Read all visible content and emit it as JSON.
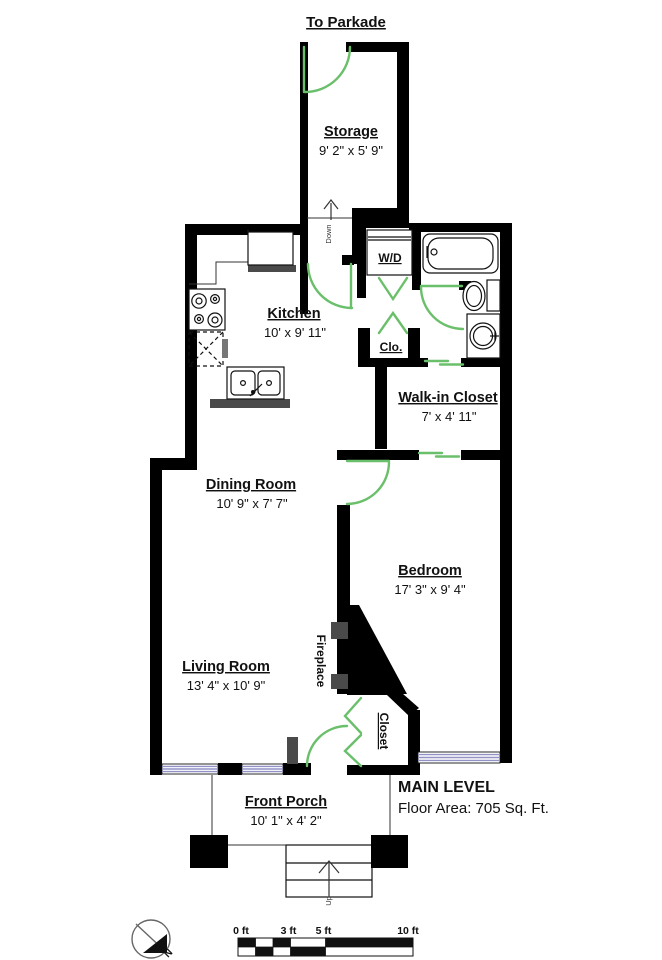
{
  "colors": {
    "wall": "#000000",
    "door_green": "#6abf6a",
    "window_lavender": "#9191c6",
    "fixture_gray": "#4a4a4a"
  },
  "title": {
    "to_parkade": "To Parkade"
  },
  "rooms": {
    "storage": {
      "name": "Storage",
      "dims": "9' 2\" x 5' 9\""
    },
    "kitchen": {
      "name": "Kitchen",
      "dims": "10' x 9' 11\""
    },
    "walk_in_closet": {
      "name": "Walk-in Closet",
      "dims": "7' x 4' 11\""
    },
    "dining_room": {
      "name": "Dining Room",
      "dims": "10' 9\" x 7' 7\""
    },
    "bedroom": {
      "name": "Bedroom",
      "dims": "17' 3\" x 9' 4\""
    },
    "living_room": {
      "name": "Living Room",
      "dims": "13' 4\" x 10' 9\""
    },
    "front_porch": {
      "name": "Front Porch",
      "dims": "10' 1\" x 4' 2\""
    }
  },
  "small_labels": {
    "wd": "W/D",
    "clo": "Clo.",
    "fireplace": "Fireplace",
    "closet": "Closet",
    "down": "Down",
    "up": "Up"
  },
  "footer": {
    "level_title": "MAIN LEVEL",
    "floor_area": "Floor Area: 705 Sq. Ft."
  },
  "scale_bar": {
    "labels": [
      "0 ft",
      "3 ft",
      "5 ft",
      "10 ft"
    ]
  },
  "compass": {
    "north": "N"
  }
}
